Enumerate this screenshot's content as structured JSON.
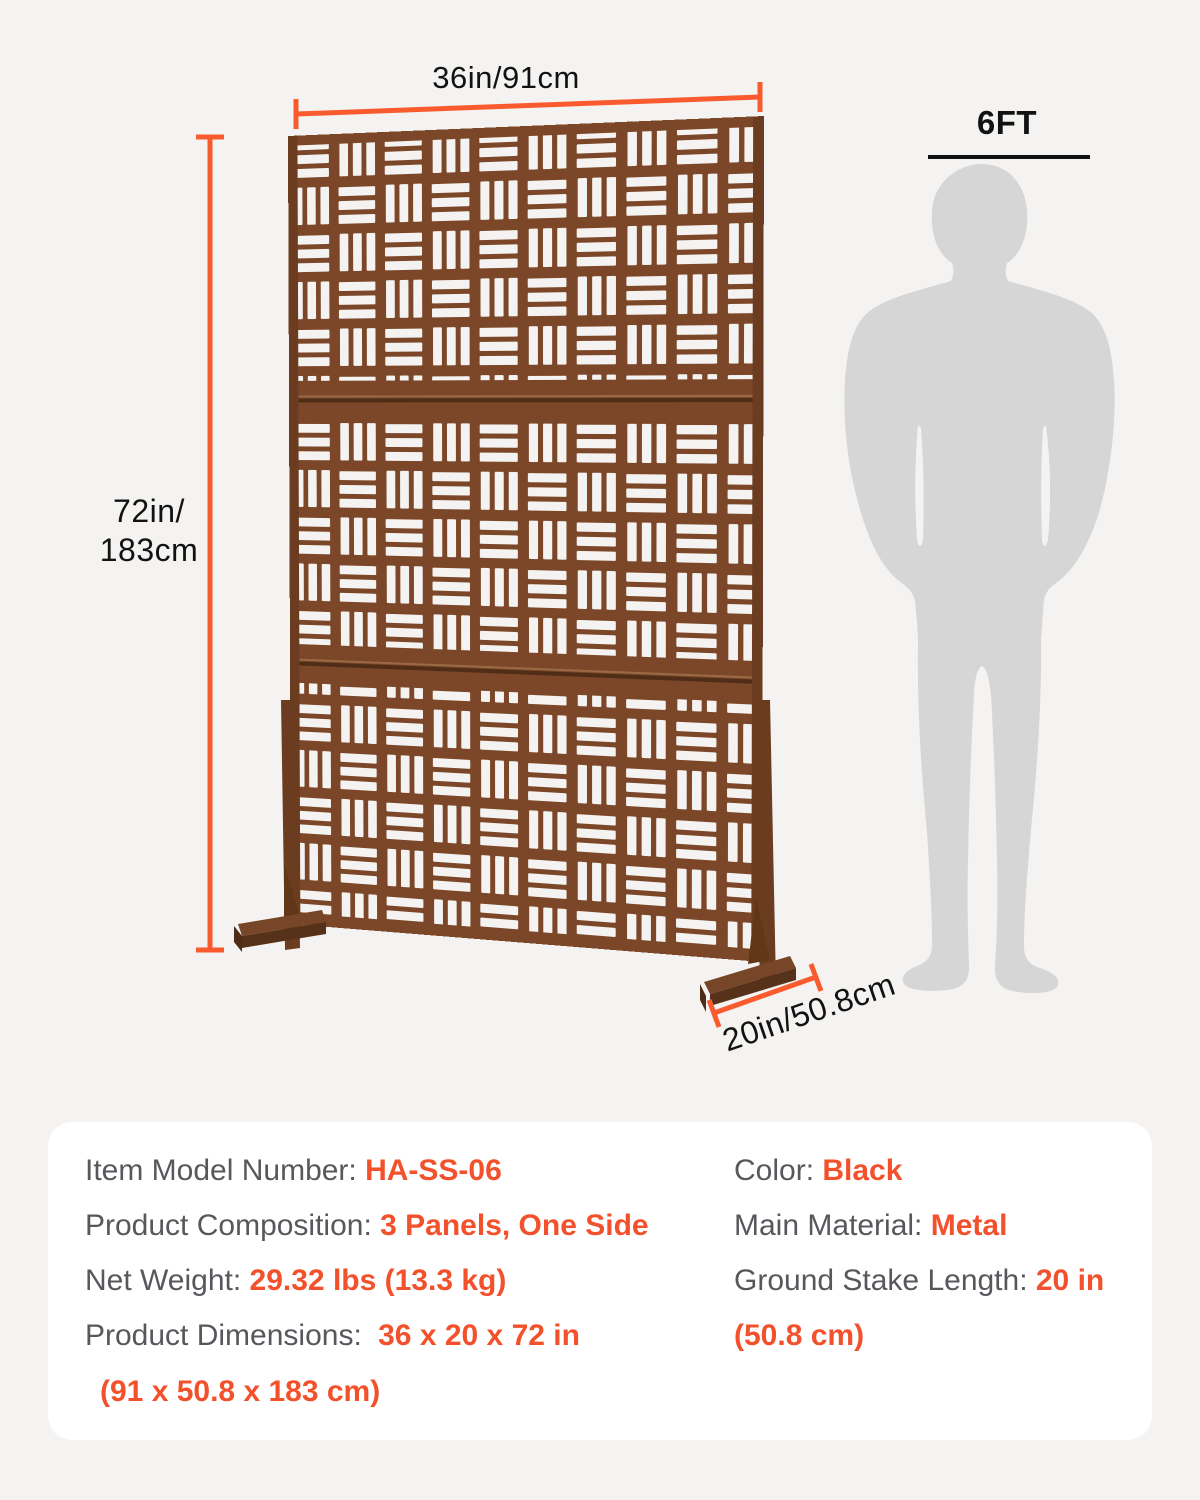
{
  "product_diagram": {
    "width_label": "36in/91cm",
    "height_label_lines": [
      "72in/",
      "183cm"
    ],
    "depth_label": "20in/50.8cm",
    "figure_height_label": "6FT"
  },
  "spec_card": {
    "left_rows": [
      {
        "label": "Item Model Number: ",
        "value": "HA-SS-06"
      },
      {
        "label": "Product Composition: ",
        "value": "3 Panels, One Side"
      },
      {
        "label": "Net Weight: ",
        "value": "29.32 lbs (13.3 kg)"
      },
      {
        "label": "Product Dimensions: ",
        "value": "36 x 20 x 72 in"
      },
      {
        "label": "",
        "value": "(91 x 50.8 x 183 cm)"
      }
    ],
    "right_rows": [
      {
        "label": "Color: ",
        "value": "Black"
      },
      {
        "label": "Main Material: ",
        "value": "Metal"
      },
      {
        "label": "Ground Stake Length: ",
        "value": "20 in"
      },
      {
        "label": "",
        "value": "(50.8 cm)"
      }
    ]
  },
  "colors": {
    "page_bg": "#f4f3f1",
    "card_bg": "#ffffff",
    "label_gray": "#56585c",
    "value_orange": "#f2512c",
    "dimension_orange": "#f95b2e",
    "panel_brown": "#7b4728",
    "panel_dark_brown": "#5c3319",
    "silhouette_gray": "#d6d6d6",
    "dimension_text_black": "#121212"
  }
}
